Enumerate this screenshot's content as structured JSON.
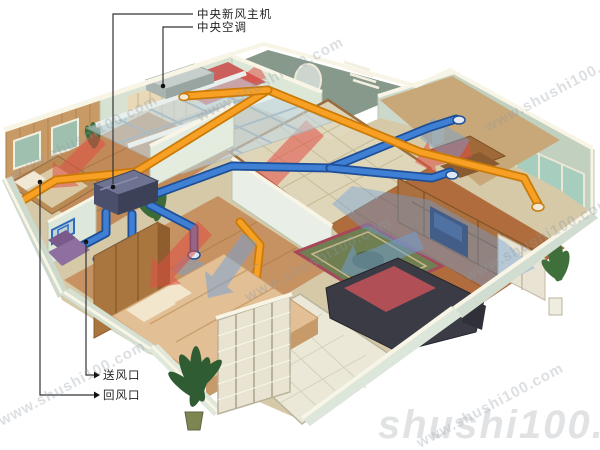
{
  "scene": {
    "type": "isometric-apartment-hvac-cutaway-illustration",
    "background": "#ffffff",
    "annotations": {
      "fresh_air_host": "中央新风主机",
      "central_ac": "中央空调",
      "supply_vent": "送风口",
      "return_vent": "回风口"
    },
    "watermark": {
      "diagonal": "www.shushi100.com",
      "footer": "shushi100.com"
    },
    "legend_colors": {
      "supply_duct_orange": "#ef9212",
      "fresh_air_duct_blue": "#2e6cc0",
      "warm_airflow_red": "#e04f46",
      "cool_airflow_blue": "#6f9fd8",
      "wall_face": "#d9e3d6",
      "wall_trim": "#f8f5e6",
      "wood_floor": "#b06c3c",
      "unit_housing_dark": "#4a4f6b"
    }
  }
}
